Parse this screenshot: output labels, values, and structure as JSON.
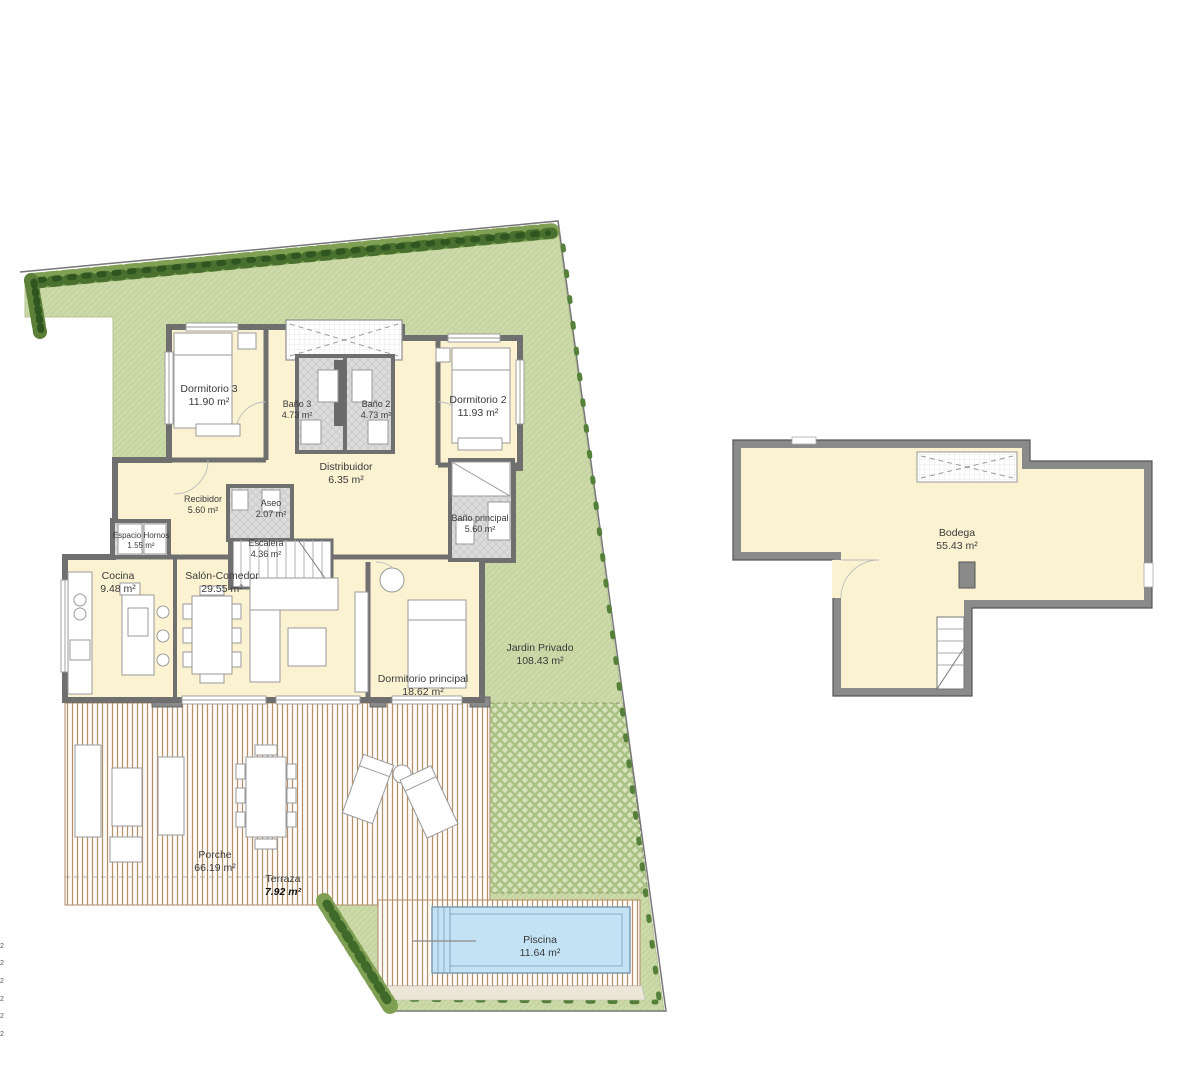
{
  "document": {
    "type": "architectural-floor-plan",
    "title": "Villa floor plan with garden, pool and bodega"
  },
  "colors": {
    "plot_green": "#ccdaa9",
    "checker_green": "#aec687",
    "hedge_dark": "#3f6a2a",
    "hedge_mid": "#7fa053",
    "room_cream": "#fbf2d2",
    "wall_gray": "#6f6f6f",
    "bath_gray": "#dcdcdc",
    "deck_stripe": "#b3906c",
    "pool_blue": "#c3e3f5",
    "pool_line": "#7d9cb0",
    "boundary_line": "#777777"
  },
  "main_plan": {
    "rooms": [
      {
        "id": "dormitorio3",
        "label": "Dormitorio 3",
        "area": "11.90 m²"
      },
      {
        "id": "bano3",
        "label": "Baño 3",
        "area": "4.73 m²"
      },
      {
        "id": "bano2",
        "label": "Baño 2",
        "area": "4.73 m²"
      },
      {
        "id": "dormitorio2",
        "label": "Dormitorio 2",
        "area": "11.93 m²"
      },
      {
        "id": "distribuidor",
        "label": "Distribuidor",
        "area": "6.35 m²"
      },
      {
        "id": "recibidor",
        "label": "Recibidor",
        "area": "5.60 m²"
      },
      {
        "id": "aseo",
        "label": "Aseo",
        "area": "2.07 m²"
      },
      {
        "id": "bano_principal",
        "label": "Baño principal",
        "area": "5.60 m²"
      },
      {
        "id": "espacio_hornos",
        "label": "Espacio Hornos",
        "area": "1.55 m²"
      },
      {
        "id": "escalera",
        "label": "Escalera",
        "area": "4.36 m²"
      },
      {
        "id": "cocina",
        "label": "Cocina",
        "area": "9.48 m²"
      },
      {
        "id": "salon_comedor",
        "label": "Salón-Comedor",
        "area": "29.55 m²"
      },
      {
        "id": "dormitorio_principal",
        "label": "Dormitorio principal",
        "area": "18.62 m²"
      },
      {
        "id": "jardin_privado",
        "label": "Jardin Privado",
        "area": "108.43 m²"
      },
      {
        "id": "porche",
        "label": "Porche",
        "area": "66.19 m²"
      },
      {
        "id": "terraza",
        "label": "Terraza",
        "area": "7.92 m²"
      },
      {
        "id": "piscina",
        "label": "Piscina",
        "area": "11.64 m²"
      }
    ]
  },
  "bodega_plan": {
    "room": {
      "id": "bodega",
      "label": "Bodega",
      "area": "55.43 m²"
    }
  },
  "margin_marks": [
    "2",
    "2",
    "2",
    "2",
    "2",
    "2"
  ]
}
